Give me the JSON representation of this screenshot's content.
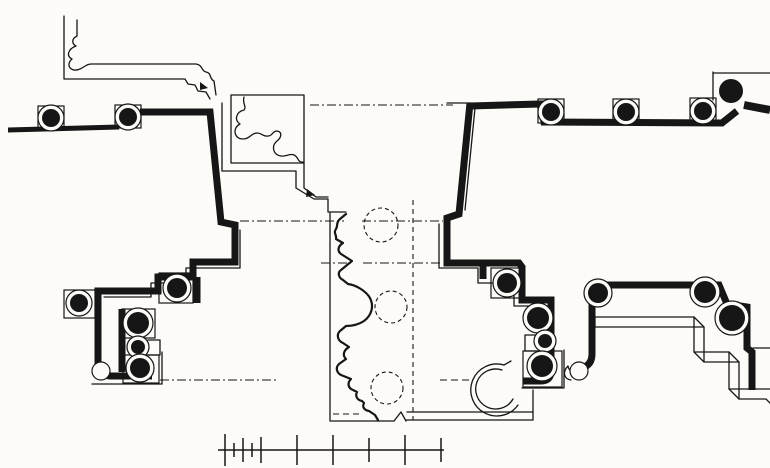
{
  "canvas": {
    "width": 770,
    "height": 468,
    "viewBox": "0 0 770 468",
    "background": "#fcfbf8",
    "ink": "#161616"
  },
  "drawing": {
    "thin_paths": [
      {
        "d": "M 64 16 V 79 H 185 L 188 84 L 195 85 L 198 91 L 206 92 L 210 99"
      },
      {
        "d": "M 77 20 V 36 C 71 39 72 44 76 46 C 68 49 66 56 72 59 C 65 65 71 73 80 69 C 86 66 87 64 92 64 H 196 C 203 65 201 71 206 72 C 212 73 209 79 214 81 L 216 95"
      },
      {
        "d": "M 231 95 H 304 V 163 H 231 Z"
      },
      {
        "d": "M 222 103 V 171 H 296 V 188 L 314 199 H 328 V 212 H 346"
      },
      {
        "d": "M 304 163 V 188 L 316 197 H 328"
      },
      {
        "d": "M 244 97 C 242 104 247 106 244 110 C 236 112 234 120 240 124 C 232 128 234 139 243 139 C 250 139 251 133 257 133 C 262 133 263 137 268 136 C 273 136 272 131 277 131 C 283 132 281 138 277 141 C 271 146 273 155 281 156 C 286 157 290 153 294 155 C 299 157 297 163 304 162"
      },
      {
        "d": "M 447 103 H 471"
      },
      {
        "d": "M 475 108 L 465 210"
      },
      {
        "d": "M 330 213 V 421 H 394"
      },
      {
        "d": "M 394 421 L 401 412 L 406 421"
      },
      {
        "d": "M 407 412 H 533"
      },
      {
        "d": "M 406 420 H 533"
      },
      {
        "d": "M 533 420 V 390"
      },
      {
        "d": "M 346 214 L 340 219 C 336 222 338 226 336 229 C 333 233 337 235 336 239 L 343 243 C 338 246 337 251 341 254 L 352 261 L 341 270 C 337 273 339 278 343 280 L 348 284 C 356 285 366 291 370 298 C 374 306 372 315 364 321 C 358 325 351 326 346 326 L 340 331 C 336 335 338 341 343 343 L 349 347 C 344 350 342 355 346 359 L 339 364 C 335 368 337 373 341 375 L 351 379 C 347 383 348 388 353 390 L 357 392 C 355 396 357 400 362 401 L 364 403 C 362 407 364 410 369 411 L 375 415 L 378 420",
        "w": 2.2
      },
      {
        "d": "M 240 230 V 268 H 186 V 283 H 151 V 297 H 104"
      },
      {
        "d": "M 439 224 V 268 H 478 V 283 H 514 V 306 H 545 V 344"
      },
      {
        "d": "M 92 384 H 162 V 352"
      },
      {
        "d": "M 148 340 H 160 V 355 H 148"
      },
      {
        "d": "M 537 335 H 525 V 351 H 537"
      },
      {
        "d": "M 522 388 H 564 V 350"
      },
      {
        "d": "M 504 365 A 26 26 0 1 0 518 405"
      },
      {
        "d": "M 502 370 A 20 20 0 1 0 513 399"
      },
      {
        "d": "M 504 365 L 511 361"
      },
      {
        "d": "M 595 317 H 694 V 352 H 729 V 389 H 770"
      },
      {
        "d": "M 595 327 H 704 V 362 H 739 V 399 H 766 L 770 403"
      },
      {
        "d": "M 595 317 V 327"
      },
      {
        "d": "M 694 317 L 704 327"
      },
      {
        "d": "M 694 352 L 704 362"
      },
      {
        "d": "M 729 352 L 739 362"
      },
      {
        "d": "M 729 389 L 739 399"
      },
      {
        "d": "M 753 348 H 770"
      },
      {
        "d": "M 713 72 V 100"
      },
      {
        "d": "M 713 73 H 770"
      },
      {
        "d": "M 584 368 C 578 375 569 373 568 366 C 562 372 564 379 571 380"
      }
    ],
    "dash_paths": [
      {
        "d": "M 310 105 H 453",
        "dash": "9 3 2 3"
      },
      {
        "d": "M 240 221 H 344",
        "dash": "9 3 2 3"
      },
      {
        "d": "M 362 221 H 443",
        "dash": "9 3 2 3"
      },
      {
        "d": "M 321 263 H 351",
        "dash": "9 3 2 3"
      },
      {
        "d": "M 363 263 H 440",
        "dash": "9 3 2 3"
      },
      {
        "d": "M 160 380 H 278",
        "dash": "9 3 2 3"
      },
      {
        "d": "M 440 380 H 469",
        "dash": "7 4"
      },
      {
        "d": "M 333 414 H 362",
        "dash": "6 4"
      },
      {
        "d": "M 413 200 V 420",
        "dash": "5 4"
      },
      {
        "d": "M 260 95 H 304",
        "dash": "6 4"
      }
    ],
    "dashed_circles": [
      {
        "cx": 381,
        "cy": 225,
        "r": 17
      },
      {
        "cx": 391,
        "cy": 307,
        "r": 16
      },
      {
        "cx": 387,
        "cy": 388,
        "r": 16
      }
    ],
    "thick_paths": [
      {
        "d": "M 8 130 L 119 127",
        "w": 5
      },
      {
        "d": "M 140 112 H 210 L 221 222 L 235 225 V 262 H 193 V 277 H 158 V 291 H 98 V 364 Q 98 375 110 376 H 152",
        "w": 7
      },
      {
        "d": "M 122 309 V 372",
        "w": 7
      },
      {
        "d": "M 197 277 V 303",
        "w": 7
      },
      {
        "d": "M 470 103 L 459 214 L 447 218 V 263 H 519 L 522 267 V 300 H 551 V 371 Q 551 381 541 381 H 523",
        "w": 7
      },
      {
        "d": "M 483 264 V 279",
        "w": 7
      },
      {
        "d": "M 470 106 L 541 104 L 544 122 L 722 123 L 737 111",
        "w": 7
      },
      {
        "d": "M 744 105 L 770 110",
        "w": 8
      },
      {
        "d": "M 592 285 H 719 L 727 304 L 747 307 V 348 L 752 352 V 390",
        "w": 7
      },
      {
        "d": "M 592 282 V 354 Q 592 365 582 368",
        "w": 7
      }
    ],
    "columns": [
      {
        "cx": 51,
        "cy": 118,
        "r": 9,
        "sq": [
          38,
          106,
          26,
          23
        ]
      },
      {
        "cx": 128,
        "cy": 117,
        "r": 9,
        "sq": [
          115,
          105,
          26,
          23
        ]
      },
      {
        "cx": 551,
        "cy": 112,
        "r": 9,
        "sq": [
          538,
          99,
          26,
          24
        ]
      },
      {
        "cx": 626,
        "cy": 112,
        "r": 9,
        "sq": [
          613,
          99,
          26,
          24
        ]
      },
      {
        "cx": 703,
        "cy": 111,
        "r": 9,
        "sq": [
          690,
          98,
          26,
          24
        ]
      },
      {
        "cx": 79,
        "cy": 303,
        "r": 9,
        "sq": [
          64,
          290,
          31,
          28
        ]
      },
      {
        "cx": 177,
        "cy": 288,
        "r": 10,
        "sq": [
          159,
          273,
          34,
          30
        ]
      },
      {
        "cx": 138,
        "cy": 323,
        "r": 11,
        "sq": [
          122,
          309,
          33,
          29
        ]
      },
      {
        "cx": 138,
        "cy": 347,
        "r": 7
      },
      {
        "cx": 140,
        "cy": 368,
        "r": 10,
        "sq": [
          123,
          355,
          36,
          28
        ]
      },
      {
        "cx": 101,
        "cy": 371,
        "r": 5,
        "ring_only": true
      },
      {
        "cx": 507,
        "cy": 283,
        "r": 10,
        "sq": [
          491,
          268,
          33,
          30
        ]
      },
      {
        "cx": 538,
        "cy": 318,
        "r": 11
      },
      {
        "cx": 545,
        "cy": 341,
        "r": 7
      },
      {
        "cx": 542,
        "cy": 366,
        "r": 11,
        "sq": [
          523,
          351,
          39,
          36
        ]
      },
      {
        "cx": 598,
        "cy": 293,
        "r": 10
      },
      {
        "cx": 705,
        "cy": 292,
        "r": 11
      },
      {
        "cx": 732,
        "cy": 318,
        "r": 13
      },
      {
        "cx": 579,
        "cy": 371,
        "r": 5,
        "ring_only": true
      }
    ],
    "solid_circles": [
      {
        "cx": 731,
        "cy": 91,
        "r": 12,
        "pad": 16
      }
    ],
    "triangles": [
      {
        "points": "200,82 208,88 200,90"
      },
      {
        "points": "307,189 315,195 306,197"
      }
    ],
    "scalebar": {
      "y": 450,
      "x1": 218,
      "x2": 444,
      "ticks": [
        {
          "x": 225,
          "h": 16
        },
        {
          "x": 234,
          "h": 7
        },
        {
          "x": 243,
          "h": 12
        },
        {
          "x": 252,
          "h": 7
        },
        {
          "x": 261,
          "h": 13
        },
        {
          "x": 297,
          "h": 15
        },
        {
          "x": 333,
          "h": 15
        },
        {
          "x": 369,
          "h": 12
        },
        {
          "x": 405,
          "h": 15
        },
        {
          "x": 441,
          "h": 12
        }
      ]
    }
  }
}
